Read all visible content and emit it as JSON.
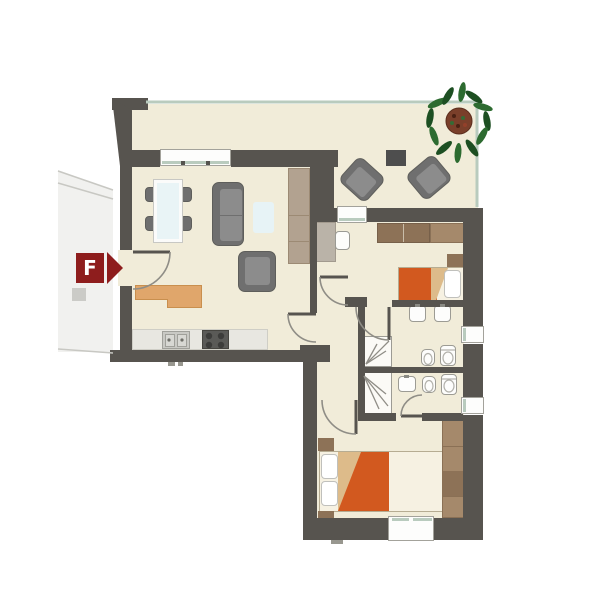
{
  "marker": {
    "label": "F"
  },
  "icons": {
    "marker_arrow": "arrow-right-icon",
    "plant": "plant-icon"
  },
  "palette": {
    "wall": "#57544f",
    "floor": "#f1ecd9",
    "glass": "#b9cbbe",
    "orange": "#d2591f",
    "fold": "#ddbb8a",
    "wood_dark": "#8d7257",
    "wood_light": "#a5896b",
    "counter_orange": "#e0a66b",
    "counter_orange_border": "#c98f4e",
    "gray_furniture": "#6f6f6f",
    "gray_cushion": "#8c8c8c",
    "marker_red": "#8e1d1d",
    "rug": "#e7f3f6",
    "white": "#fdfdfc",
    "plant_green": "#2d6b30",
    "plant_green_dark": "#1d4f22",
    "pot": "#7a3f2a",
    "counter_gray": "#e8e7e1",
    "cabinet_tan": "#b2a290",
    "desk_taupe": "#bab3a8",
    "bed_base": "#f6f1e2",
    "wood_border": "#b6ac92",
    "fixture_border": "#9c9b94",
    "neighbor": "#ececea",
    "neighbor_line": "#c8c8c3",
    "stove": "#5a5a57",
    "sink_gray": "#c9c9c4",
    "window_border": "#a3a29b",
    "arc_gray": "#8f8d86",
    "tick": "#98978f"
  }
}
